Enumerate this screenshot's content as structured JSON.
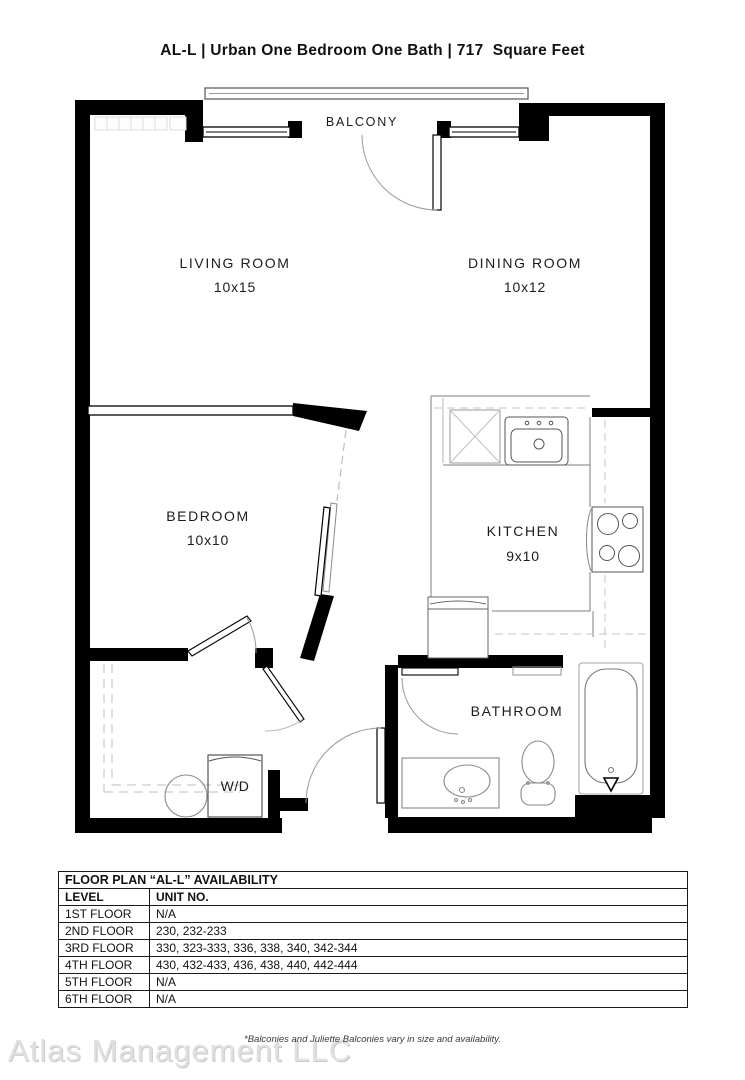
{
  "page": {
    "title": "AL-L | Urban One Bedroom One Bath | 717  Square Feet"
  },
  "floor_plan": {
    "balcony": "BALCONY",
    "living_room": {
      "label": "LIVING ROOM",
      "dims": "10x15"
    },
    "dining_room": {
      "label": "DINING ROOM",
      "dims": "10x12"
    },
    "bedroom": {
      "label": "BEDROOM",
      "dims": "10x10"
    },
    "kitchen": {
      "label": "KITCHEN",
      "dims": "9x10"
    },
    "bathroom": {
      "label": "BATHROOM"
    },
    "washer_dryer": {
      "label": "W/D"
    }
  },
  "availability_table": {
    "title": "FLOOR PLAN “AL-L” AVAILABILITY",
    "columns": [
      "LEVEL",
      "UNIT NO."
    ],
    "rows": [
      {
        "level": "1ST FLOOR",
        "units": "N/A"
      },
      {
        "level": "2ND FLOOR",
        "units": "230, 232-233"
      },
      {
        "level": "3RD FLOOR",
        "units": "330, 323-333, 336, 338, 340, 342-344"
      },
      {
        "level": "4TH FLOOR",
        "units": "430, 432-433, 436, 438, 440, 442-444"
      },
      {
        "level": "5TH FLOOR",
        "units": "N/A"
      },
      {
        "level": "6TH FLOOR",
        "units": "N/A"
      }
    ]
  },
  "footnote": "*Balconies and Juliette Balconies vary in size and availability.",
  "watermark": "Atlas Management LLC",
  "colors": {
    "wall": "#000000",
    "fixture_line": "#8a8a8a",
    "dashed_line": "#c4c4c4",
    "text": "#1a1a1a",
    "watermark": "#e0e0e0"
  }
}
